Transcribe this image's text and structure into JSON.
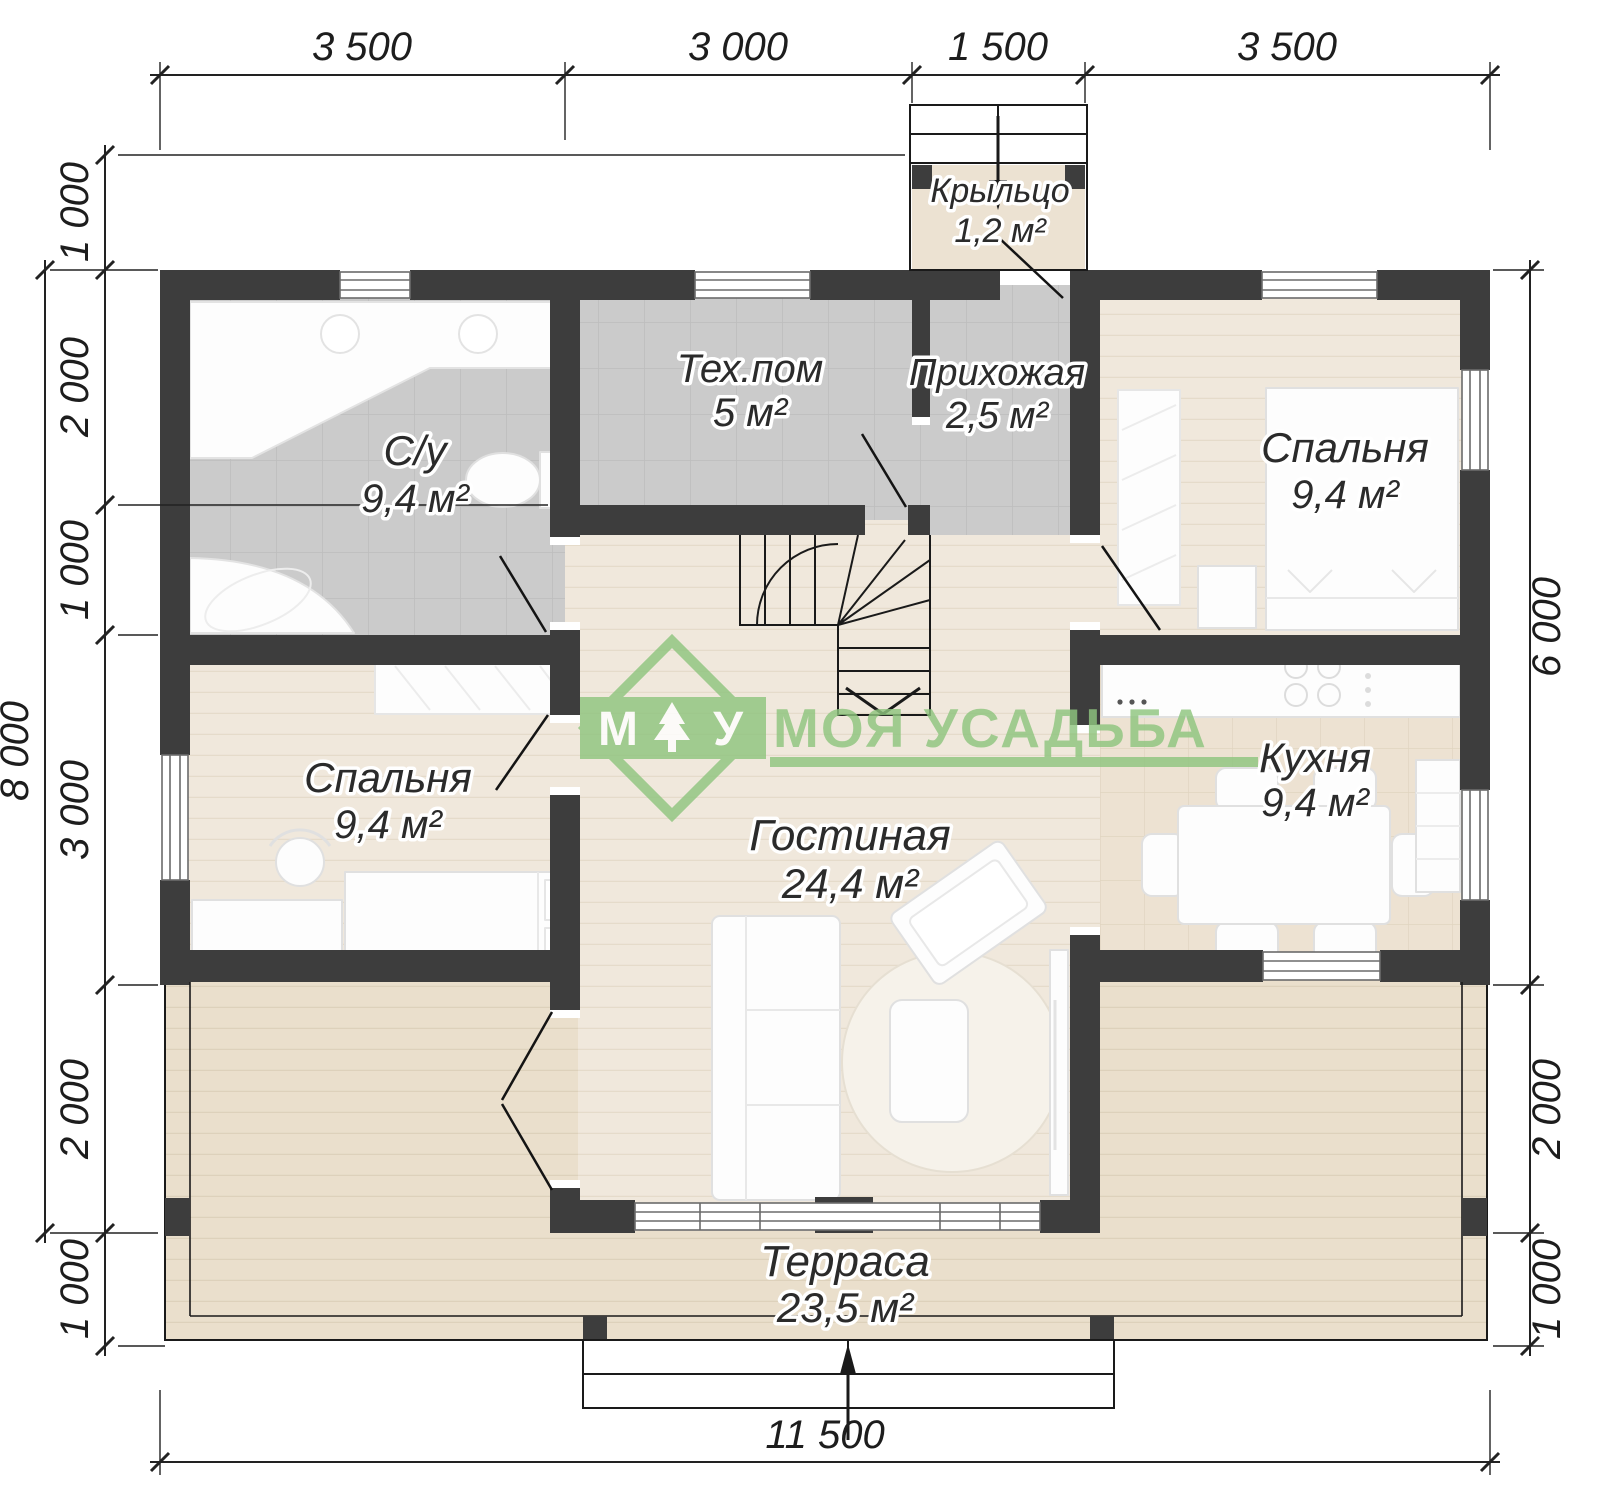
{
  "watermark": {
    "m": "М",
    "u": "У",
    "brand": "МОЯ УСАДЬБА",
    "color": "#8fc57f"
  },
  "rooms": [
    {
      "id": "porch",
      "name": "Крыльцо",
      "area": "1,2 м²"
    },
    {
      "id": "tech-room",
      "name": "Тех.пом",
      "area": "5 м²"
    },
    {
      "id": "hallway",
      "name": "Прихожая",
      "area": "2,5 м²"
    },
    {
      "id": "bathroom",
      "name": "С/у",
      "area": "9,4 м²"
    },
    {
      "id": "bedroom-top",
      "name": "Спальня",
      "area": "9,4 м²"
    },
    {
      "id": "bedroom-left",
      "name": "Спальня",
      "area": "9,4 м²"
    },
    {
      "id": "kitchen",
      "name": "Кухня",
      "area": "9,4 м²"
    },
    {
      "id": "living-room",
      "name": "Гостиная",
      "area": "24,4 м²"
    },
    {
      "id": "terrace",
      "name": "Терраса",
      "area": "23,5 м²"
    }
  ],
  "dimensions": {
    "top_segments": [
      "3 500",
      "3 000",
      "1 500",
      "3 500"
    ],
    "total_width": "11 500",
    "total_height": "8 000",
    "left_chain": [
      "1 000",
      "2 000",
      "1 000",
      "3 000",
      "2 000",
      "1 000"
    ],
    "right_chain": [
      "6 000",
      "2 000",
      "1 000"
    ]
  },
  "colors": {
    "wall": "#3d3d3d",
    "floor_beige": "#f0e8dc",
    "floor_terrace": "#eadfcc",
    "floor_gray": "#cbcbcb",
    "accent_green": "#8fc57f"
  }
}
